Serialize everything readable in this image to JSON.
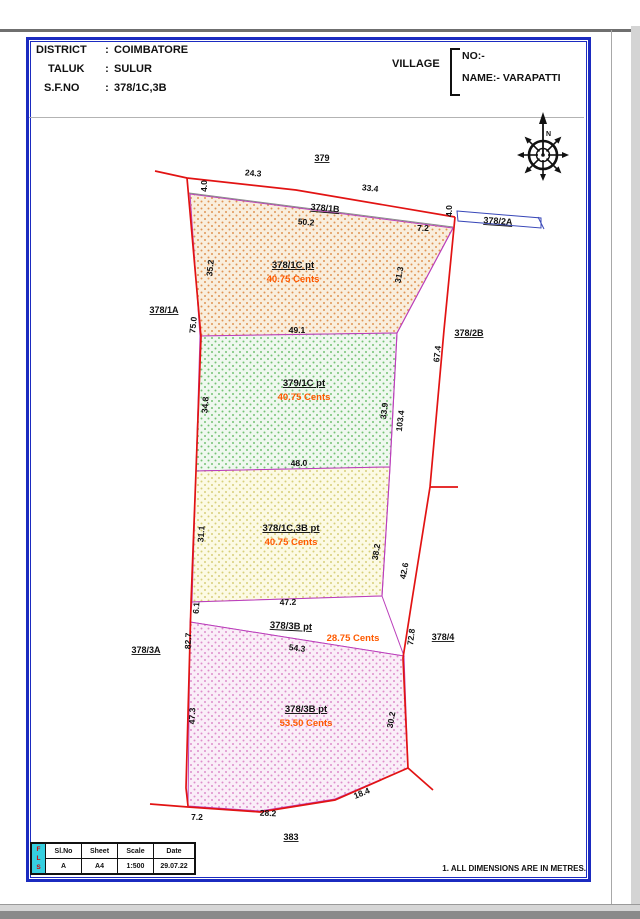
{
  "header": {
    "rows": [
      {
        "label": "DISTRICT",
        "sep": ":",
        "value": "COIMBATORE"
      },
      {
        "label": "TALUK",
        "sep": ":",
        "value": "SULUR"
      },
      {
        "label": "S.F.NO",
        "sep": ":",
        "value": "378/1C,3B"
      }
    ]
  },
  "village": {
    "label": "VILLAGE",
    "no_label": "NO:-",
    "name_label": "NAME:-",
    "name_value": "VARAPATTI"
  },
  "compass": {
    "north": "N"
  },
  "plot": {
    "adjacent": {
      "north": "379",
      "strip_north": "378/1B",
      "strip_east": "378/2A",
      "west_top": "378/1A",
      "east_top": "378/2B",
      "west_bottom": "378/3A",
      "east_bottom": "378/4",
      "south": "383"
    },
    "parcels": [
      {
        "id": "378/1C pt",
        "area": "40.75 Cents"
      },
      {
        "id": "379/1C pt",
        "area": "40.75 Cents"
      },
      {
        "id": "378/1C,3B pt",
        "area": "40.75 Cents"
      },
      {
        "id": "378/3B pt",
        "area": "28.75 Cents"
      },
      {
        "id": "378/3B pt",
        "area": "53.50 Cents"
      }
    ],
    "dims": {
      "top_tick_left": "4.0",
      "top_seg_a": "24.3",
      "top_seg_b": "33.4",
      "top_tick_right": "4.0",
      "east_7_2": "7.2",
      "strip_len": "50.2",
      "p1_west": "35.2",
      "west_total": "75.0",
      "p1_east": "31.3",
      "p1_south": "49.1",
      "p2_west": "34.8",
      "p2_east": "33.9",
      "east_total": "103.4",
      "east_67_4": "67.4",
      "p2_south": "48.0",
      "p3_west": "31.1",
      "p3_east": "38.2",
      "east_42_6": "42.6",
      "p3_south": "47.2",
      "sliver_west": "6.1",
      "west_82_7": "82.7",
      "sliver_south": "54.3",
      "east_72_8": "72.8",
      "p4_west": "47.3",
      "p4_east": "30.2",
      "south_7_2": "7.2",
      "south_28_2": "28.2",
      "south_18_4": "18.4"
    }
  },
  "footer": {
    "logo": [
      "F",
      "L",
      "S"
    ],
    "table_headers": [
      "Sl.No",
      "Sheet",
      "Scale",
      "Date"
    ],
    "table_values": [
      "A",
      "A4",
      "1:500",
      "29.07.22"
    ],
    "note": "1. ALL DIMENSIONS ARE IN METRES."
  },
  "colors": {
    "boundary_red": "#e21313",
    "parcel_edge_magenta": "#bb3fbb",
    "frame_blue": "#1b2bc0",
    "area_text_orange": "#ff5a00",
    "logo_cyan": "#35cfe0"
  }
}
